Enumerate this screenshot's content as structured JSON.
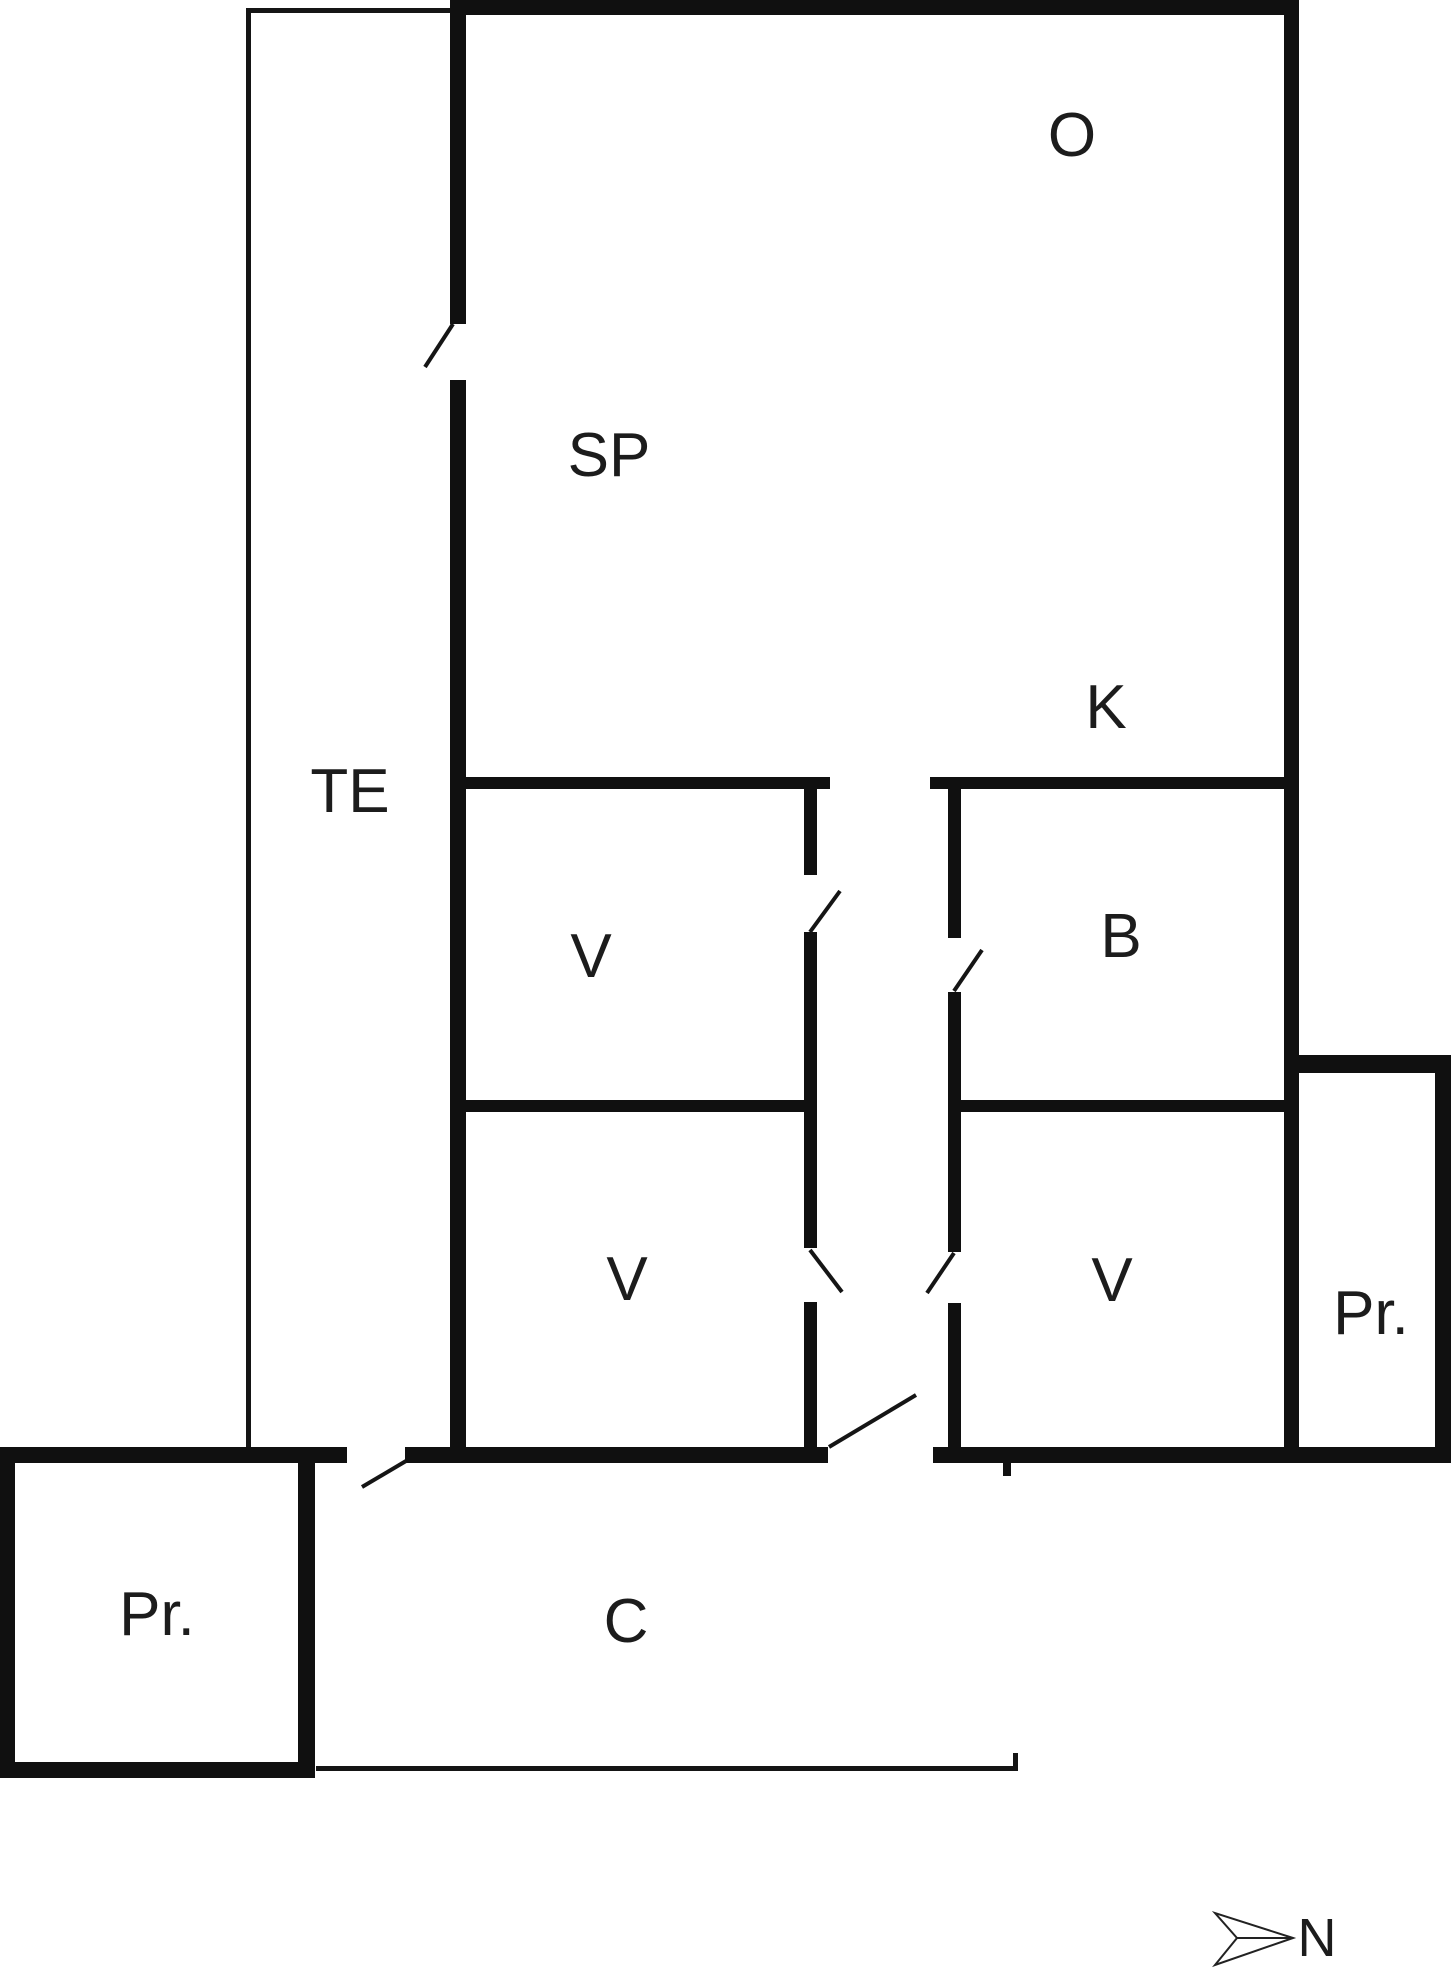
{
  "plan": {
    "type": "floor-plan",
    "labels": {
      "o": "O",
      "sp": "SP",
      "te": "TE",
      "k": "K",
      "v_top": "V",
      "b": "B",
      "v_bottom_left": "V",
      "v_bottom_right": "V",
      "pr_right": "Pr.",
      "pr_left": "Pr.",
      "c": "C"
    },
    "compass": {
      "north": "N"
    },
    "colors": {
      "wall": "#101010",
      "background": "#ffffff",
      "text": "#1c1c1c"
    }
  }
}
